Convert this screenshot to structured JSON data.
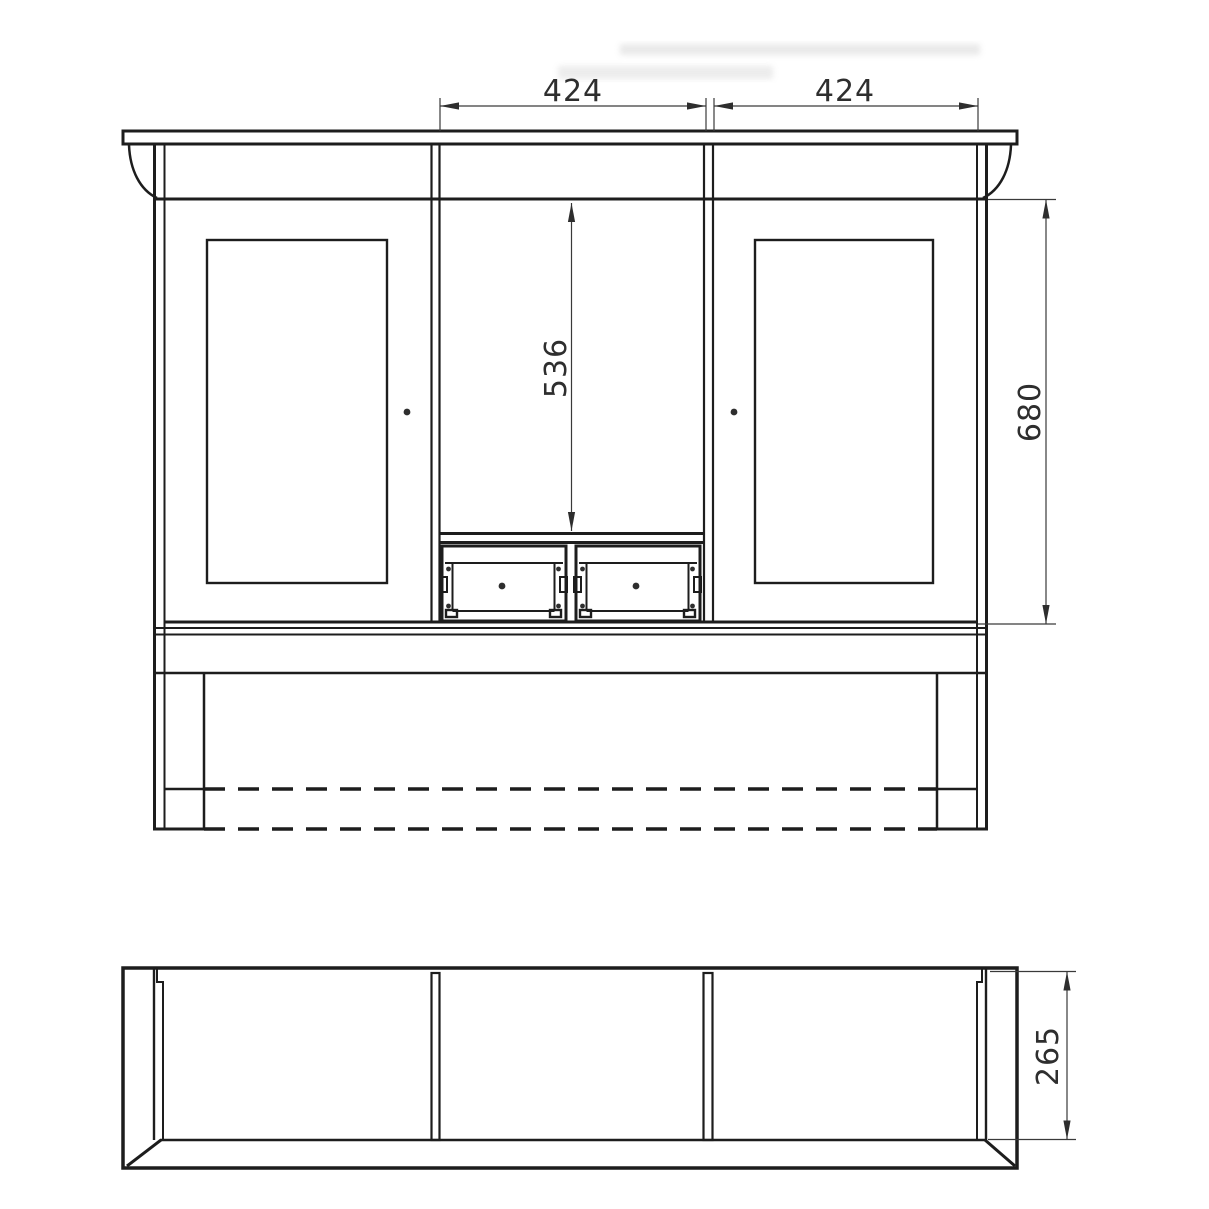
{
  "drawing": {
    "type": "furniture-technical-drawing",
    "views": {
      "front": {
        "name": "front-elevation",
        "features": [
          "crown-top-board",
          "left-corbel",
          "right-corbel",
          "left-door-panel",
          "right-door-panel",
          "center-open-shelf",
          "two-drawers",
          "bottom-rails",
          "side-legs",
          "hidden-dashed-edges"
        ]
      },
      "plan": {
        "name": "top-plan-view",
        "features": [
          "outer-body",
          "side-panels",
          "two-partitions",
          "front-board",
          "mitre-corners"
        ]
      }
    },
    "dimensions": [
      {
        "id": "top-left-width",
        "value": "424",
        "orientation": "horizontal"
      },
      {
        "id": "top-right-width",
        "value": "424",
        "orientation": "horizontal"
      },
      {
        "id": "center-opening-height",
        "value": "536",
        "orientation": "vertical"
      },
      {
        "id": "side-height",
        "value": "680",
        "orientation": "vertical"
      },
      {
        "id": "depth",
        "value": "265",
        "orientation": "vertical"
      }
    ],
    "colors": {
      "line": "#1d1d1d",
      "dimension_line": "#3a3a3a",
      "text": "#2e2e2e",
      "background": "#ffffff"
    }
  }
}
